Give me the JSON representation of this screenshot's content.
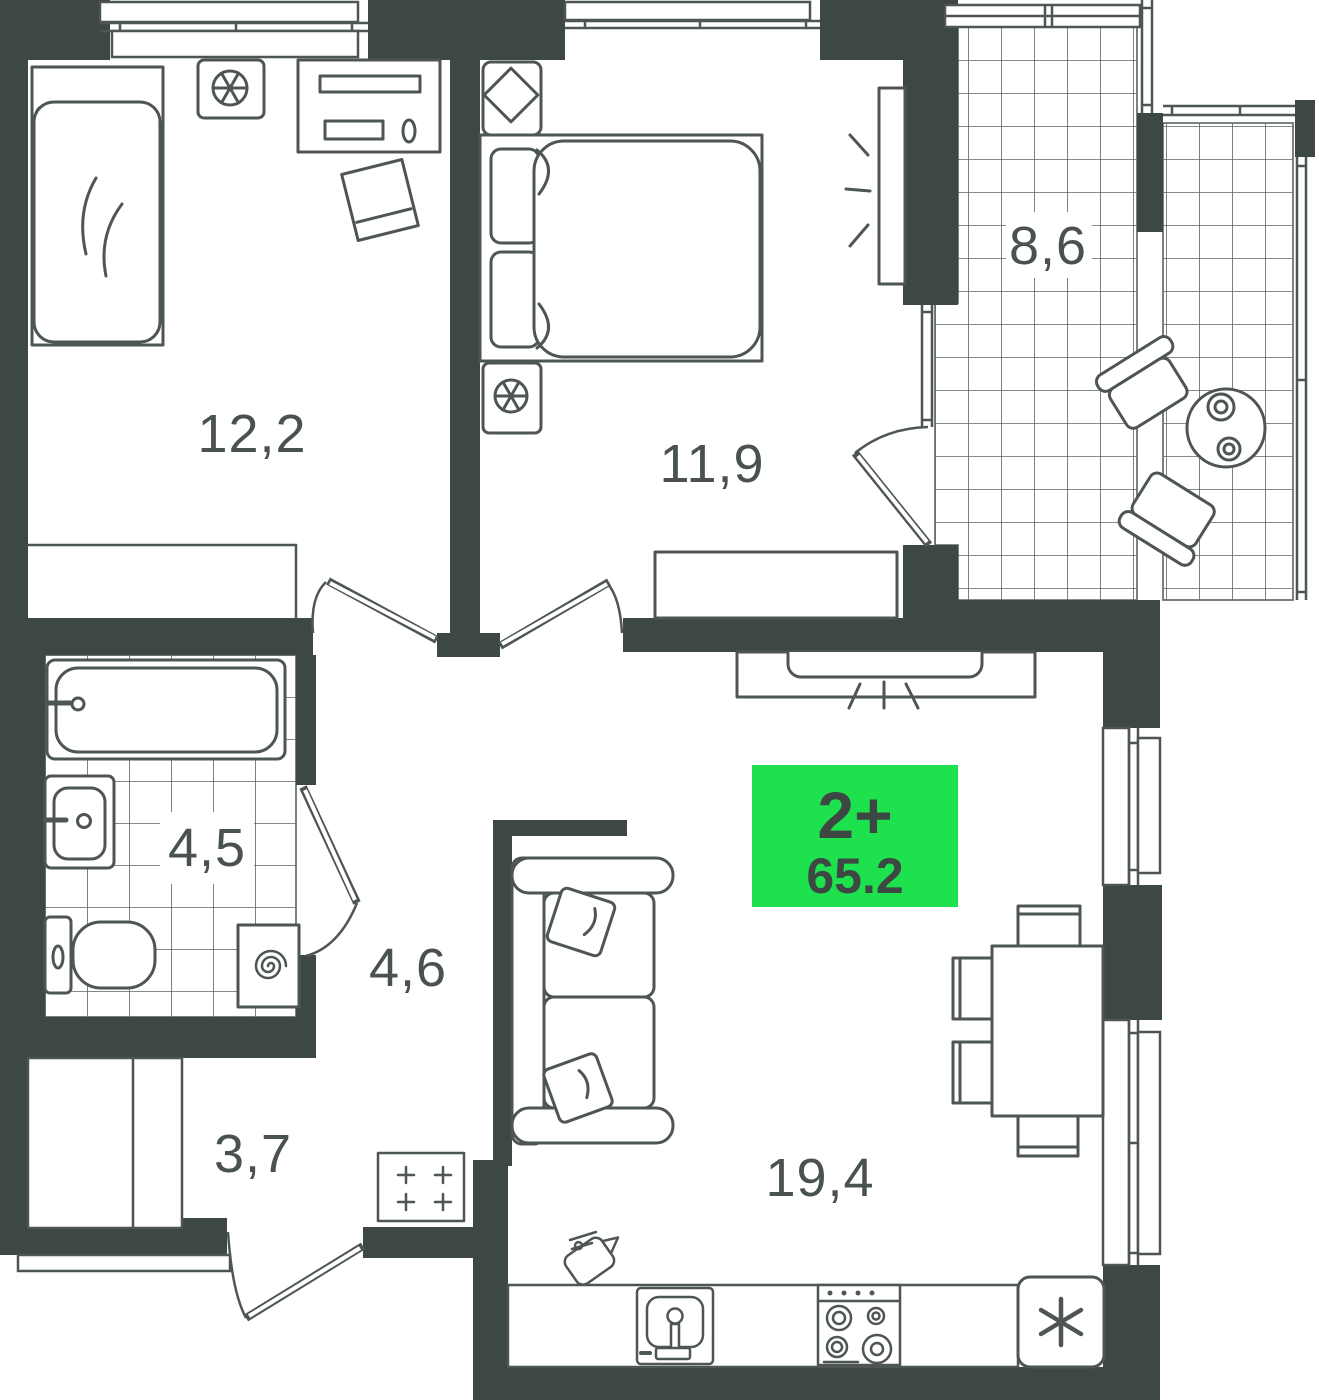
{
  "plan": {
    "badge": {
      "rooms_label": "2+",
      "area_value": "65.2"
    },
    "rooms": [
      {
        "name": "bedroom-1",
        "area_label": "12,2"
      },
      {
        "name": "bedroom-2",
        "area_label": "11,9"
      },
      {
        "name": "balcony",
        "area_label": "8,6"
      },
      {
        "name": "bathroom",
        "area_label": "4,5"
      },
      {
        "name": "hallway",
        "area_label": "4,6"
      },
      {
        "name": "entry-hall",
        "area_label": "3,7"
      },
      {
        "name": "kitchen-living-room",
        "area_label": "19,4"
      }
    ],
    "colors": {
      "wall": "#3d4743",
      "furniture_line": "#4e5652",
      "tile_line": "#5c635f",
      "badge_green": "#1de24e",
      "badge_text": "#3d4743",
      "label_text": "#4a524d",
      "background": "#ffffff"
    }
  }
}
